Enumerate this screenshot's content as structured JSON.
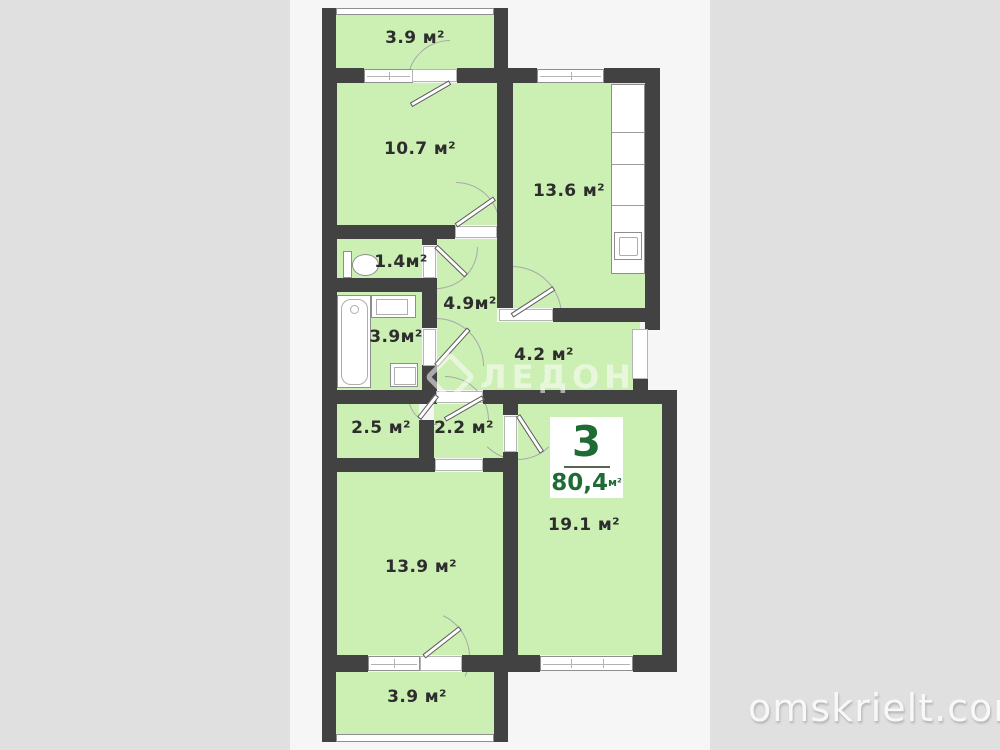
{
  "page": {
    "background_color": "#e0e0e0",
    "plan_background_color": "#f6f6f6"
  },
  "palette": {
    "wall_color": "#424242",
    "room_fill_color": "#ccefb3",
    "fixture_color": "#ffffff",
    "label_text_color": "#2d2d2d",
    "badge_text_color": "#1e6b33"
  },
  "rooms": [
    {
      "id": "balcony-top",
      "label": "3.9 м²"
    },
    {
      "id": "bedroom-10-7",
      "label": "10.7 м²"
    },
    {
      "id": "kitchen-13-6",
      "label": "13.6 м²"
    },
    {
      "id": "wc-1-4",
      "label": "1.4м²"
    },
    {
      "id": "hallway-4-9",
      "label": "4.9м²"
    },
    {
      "id": "bathroom-3-9",
      "label": "3.9м²"
    },
    {
      "id": "corridor-4-2",
      "label": "4.2 м²"
    },
    {
      "id": "storage-2-5",
      "label": "2.5 м²"
    },
    {
      "id": "storage-2-2",
      "label": "2.2 м²"
    },
    {
      "id": "bedroom-13-9",
      "label": "13.9 м²"
    },
    {
      "id": "living-19-1",
      "label": "19.1 м²"
    },
    {
      "id": "balcony-bottom",
      "label": "3.9 м²"
    }
  ],
  "badge": {
    "rooms_count": "3",
    "area": "80,4",
    "area_unit": "м²"
  },
  "watermarks": {
    "developer_logo_text": "ЛЕДОН",
    "site": "omskrielt.com"
  }
}
